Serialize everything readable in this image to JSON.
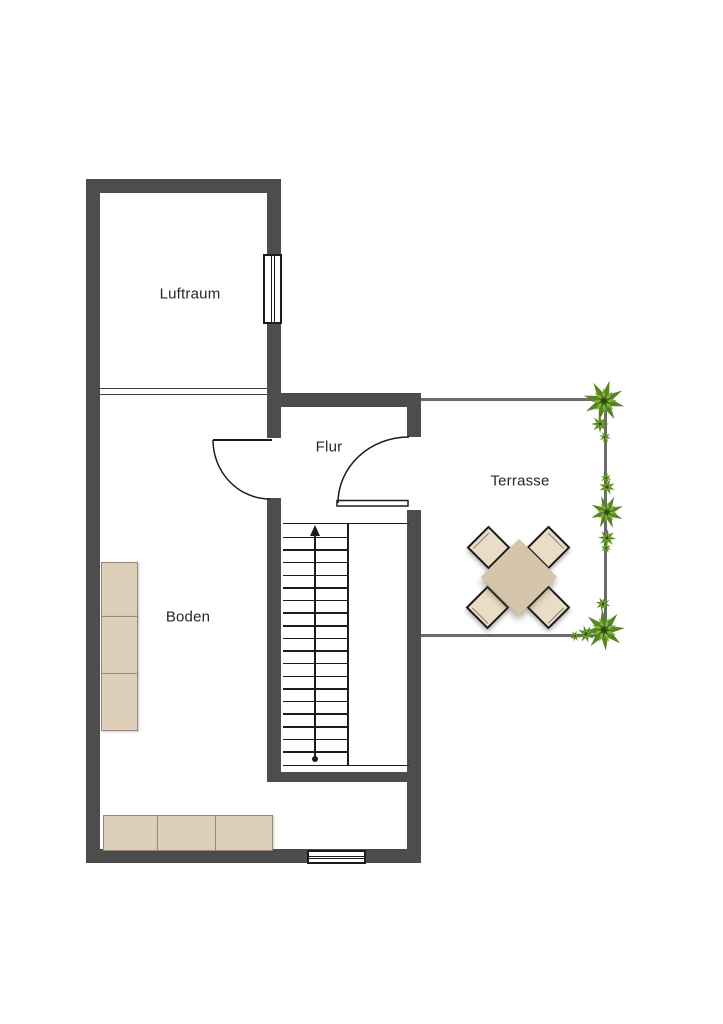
{
  "plan": {
    "type": "floor-plan",
    "rooms": [
      {
        "id": "luftraum",
        "label": "Luftraum"
      },
      {
        "id": "flur",
        "label": "Flur"
      },
      {
        "id": "boden",
        "label": "Boden"
      },
      {
        "id": "terrasse",
        "label": "Terrasse"
      }
    ],
    "stairs": {
      "steps": 19,
      "arrow": "up"
    },
    "furniture": {
      "boden_wall_cabinets": 3,
      "boden_bottom_cabinets": 3,
      "terrace_tables": 1,
      "terrace_chairs": 4
    },
    "windows": 2,
    "doors": 2,
    "plants": 3
  },
  "colors": {
    "bg": "#ffffff",
    "wall": "#4d4d4d",
    "line": "#1c1c1c",
    "tline": "#6b6b6b",
    "furn": "#ddcfba",
    "furnBorder": "#95897a",
    "tableFill": "#d5c5aa",
    "chairFill": "#eaddc7",
    "chairBorder": "#191919",
    "labelColor": "#272727",
    "plantDark": "#3c6316",
    "plantMid": "#578521",
    "plantLight": "#80ae3d"
  }
}
